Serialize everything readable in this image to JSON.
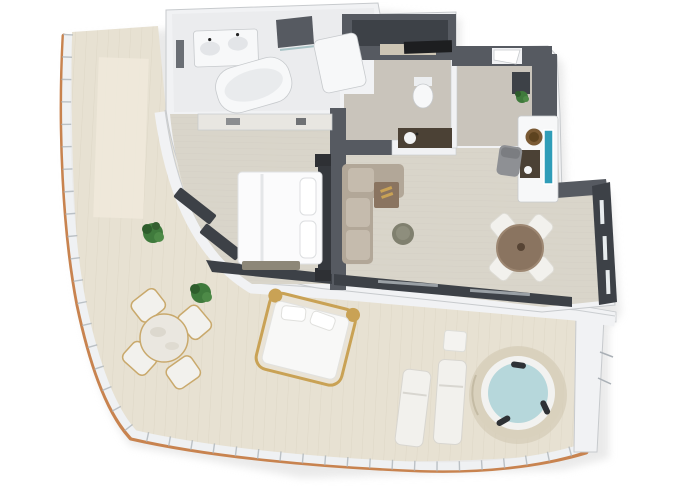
{
  "image": {
    "kind": "3d-rendered-top-down-floor-plan",
    "subject": "one-bedroom suite with wraparound curved terrace",
    "background": "#ffffff",
    "width_px": 680,
    "height_px": 486
  },
  "palette": {
    "wall_white": "#f1f2f4",
    "wall_dark": "#565a61",
    "wall_darker": "#3d4147",
    "edge": "#c7cacd",
    "floor_indoor": "#d9d5ca",
    "floor_indoor_line": "#cbc6b9",
    "floor_entry": "#c9c4bb",
    "deck": "#e7e1d2",
    "deck_line": "#d6cebb",
    "wood_trim": "#c8834f",
    "railing": "#eff1f3",
    "railing_line": "#aab0b6",
    "fixture_white": "#f7f8f9",
    "sofa": "#b2a798",
    "sofa_light": "#c5bbad",
    "table_brown": "#8a7460",
    "pouf": "#80806f",
    "chair_white": "#f2f1ed",
    "chair_tan": "#c9a96c",
    "bed_white": "#fbfbfc",
    "headboard": "#35383d",
    "water": "#b6d7db",
    "jacuzzi_rim": "#d9d1bd",
    "tv_teal": "#2f9db8",
    "bowl_brown": "#7a5a34",
    "counter_black": "#1d1e20",
    "vanity_brown": "#4b4135",
    "plant": "#3f7a3c",
    "gold": "#c9a255"
  },
  "rooms": [
    {
      "name": "terrace",
      "floor": "wood-deck"
    },
    {
      "name": "side-balcony",
      "floor": "wood-deck"
    },
    {
      "name": "bedroom",
      "floor": "light-wood"
    },
    {
      "name": "living-room",
      "floor": "light-wood"
    },
    {
      "name": "dining-area",
      "floor": "light-wood"
    },
    {
      "name": "bathroom",
      "floor": "white-tile"
    },
    {
      "name": "walk-in-closet",
      "floor": "dark"
    },
    {
      "name": "toilet-room",
      "floor": "grey"
    },
    {
      "name": "entry-hall",
      "floor": "grey"
    }
  ],
  "furniture": {
    "terrace": [
      "round-outdoor-table",
      "outdoor-chair x4",
      "daybed",
      "sun-lounger x2",
      "side-table",
      "jacuzzi",
      "plant x2"
    ],
    "bedroom": [
      "double-bed",
      "pillows x2",
      "headboard",
      "nightstand x2",
      "foot-bench",
      "dresser",
      "window-bench x2"
    ],
    "living-room": [
      "l-shaped-sofa",
      "corner-tray-table",
      "round-pouf"
    ],
    "dining-area": [
      "round-dining-table",
      "dining-chair x4"
    ],
    "desk-nook": [
      "media-console",
      "tv-screen",
      "round-bowl-sink",
      "desk-chair"
    ],
    "bathroom": [
      "double-vanity",
      "freestanding-bathtub",
      "shower"
    ],
    "toilet-room": [
      "toilet",
      "vanity-cabinet"
    ],
    "entry-hall": [
      "entry-door",
      "console-cabinet",
      "potted-plant"
    ]
  },
  "counts": {
    "outdoor_chairs": 4,
    "dining_chairs": 4,
    "sun_loungers": 2,
    "plants_terrace": 2,
    "jacuzzi_headrests": 3
  }
}
